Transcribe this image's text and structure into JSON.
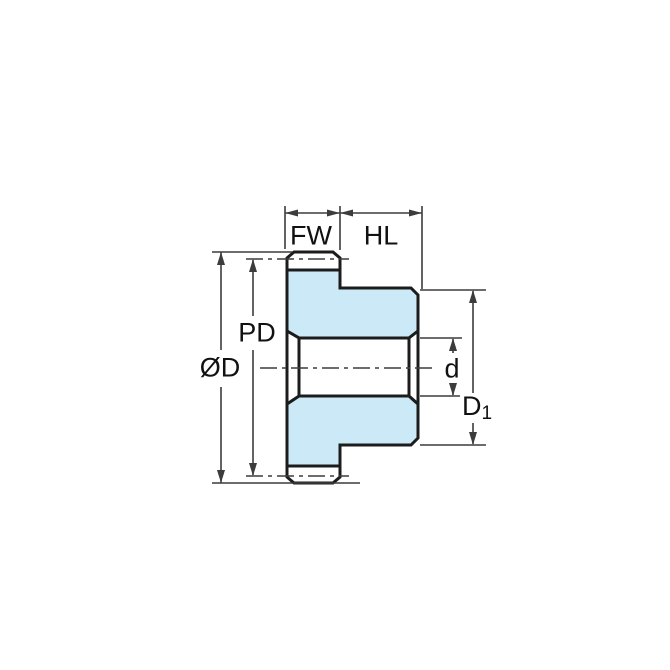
{
  "diagram": {
    "type": "gear-dimension-drawing",
    "labels": {
      "fw": "FW",
      "hl": "HL",
      "pd": "PD",
      "od": "ØD",
      "d": "d",
      "d1_base": "D",
      "d1_sub": "1"
    },
    "colors": {
      "gear_fill": "#cce9f8",
      "outline": "#1c1c1c",
      "dimension": "#3c3c3c",
      "text": "#111111",
      "background": "#ffffff"
    }
  }
}
